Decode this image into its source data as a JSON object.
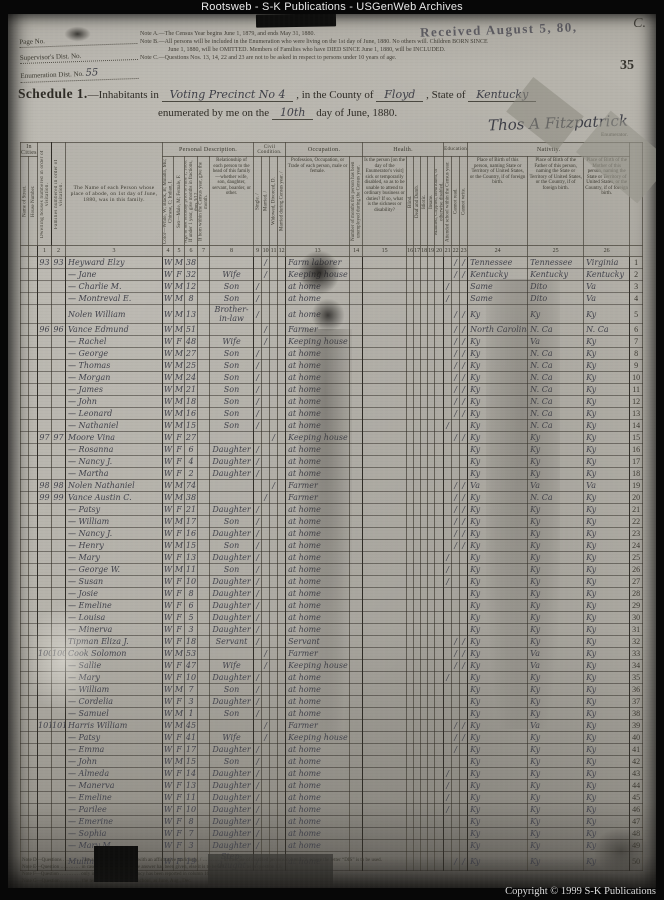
{
  "banner": "Rootsweb - S-K Publications - USGenWeb Archives",
  "copyright": "Copyright © 1999 S-K Publications",
  "page": {
    "received_stamp": "Received August 5, 80,",
    "corner_mark": "C.",
    "sheet_number": "35",
    "ids": {
      "page_no_label": "Page No.",
      "supervisor_label": "Supervisor's Dist. No.",
      "enumeration_label": "Enumeration Dist. No.",
      "enumeration_value": "55"
    },
    "notes": {
      "a": "Note A.—The Census Year begins June 1, 1879, and ends May 31, 1880.",
      "b1": "Note B.—All persons will be included in the Enumeration who were living on the 1st day of June, 1880.  No others will.  Children BORN SINCE",
      "b2": "June 1, 1880, will be OMITTED.  Members of Families who have DIED SINCE June 1, 1880, will be INCLUDED.",
      "c": "Note C.—Questions Nos. 13, 14, 22 and 23 are not to be asked in respect to persons under 10 years of age."
    },
    "schedule": {
      "title": "Schedule 1.",
      "line1_pre": "—Inhabitants in",
      "precinct": "Voting Precinct No 4",
      "county_label": ", in the County of",
      "county": "Floyd",
      "state_label": ", State of",
      "state": "Kentucky",
      "line2_pre": "enumerated by me on the",
      "day": "10th",
      "line2_post": "day of June, 1880.",
      "signature": "Thos A Fitzpatrick",
      "enumerator_label": "Enumerator."
    },
    "footnotes": [
      "Note D—Questions ………… are always to be answered with an affirmative mark only, / ………… in the case of disabled persons column 21, where the letter “DIS” is to be used.",
      "Note E—Question ………… in cases where an affirmative answer has been given, else it is to be left ………… as in question 13.",
      "Note F—Question ………… only in case a yearly occupancy has been reported in column 16.",
      "Note G—Question ………… the term of the year then in school, as June, Aug., Dec."
    ]
  },
  "table": {
    "groups": {
      "in_cities": "In Cities.",
      "personal": "Personal Description.",
      "civil": "Civil Condition.",
      "occupation": "Occupation.",
      "health": "Health.",
      "education": "Education.",
      "nativity": "Nativity."
    },
    "columns": {
      "street": "Name of Street.",
      "house": "House Number.",
      "c1": "Dwelling houses numbered in order of visitation.",
      "c2": "Families numbered in order of visitation.",
      "c3": "The Name of each Person whose place of abode, on 1st day of June, 1880, was in this family.",
      "c4": "Color—White, W; Black, B; Mulatto, Mu; Chinese, C; Indian, I.",
      "c5": "Sex—Male, M; Female, F.",
      "c6": "Age at last birthday prior to June 1, 1880. If under 1 year, give months in fractions, thus 3/12.",
      "c7": "If born within the Census year, give the month.",
      "c8": "Relationship of each person to the head of this family—whether wife, son, daughter, servant, boarder, or other.",
      "c9": "Single. /",
      "c10": "Married. /",
      "c11": "Widowed, Divorced, D.",
      "c12": "Married during Census year. /",
      "c13": "Profession, Occupation, or Trade of each person, male or female.",
      "c14": "Number of months this person has been unemployed during the Census year.",
      "c15": "Is the person [on the day of the Enumerator's visit] sick or temporarily disabled, so as to be unable to attend to ordinary business or duties? If so, what is the sickness or disability?",
      "c16": "Blind.",
      "c17": "Deaf and Dumb.",
      "c18": "Idiotic.",
      "c19": "Insane.",
      "c20": "Maimed, Crippled, Bedridden, or otherwise disabled.",
      "c21": "Attended school within the Census year.",
      "c22": "Cannot read.",
      "c23": "Cannot write.",
      "c24": "Place of Birth of this person, naming State or Territory of United States, or the Country, if of foreign birth.",
      "c25": "Place of Birth of the Father of this person, naming the State or Territory of United States, or the Country, if of foreign birth.",
      "c26": "Place of Birth of the Mother of this person, naming the State or Territory of United States, or the Country, if of foreign birth."
    },
    "numbers": [
      "1",
      "2",
      "3",
      "4",
      "5",
      "6",
      "7",
      "8",
      "9",
      "10",
      "11",
      "12",
      "13",
      "14",
      "15",
      "16",
      "17",
      "18",
      "19",
      "20",
      "21",
      "22",
      "23",
      "24",
      "25",
      "26"
    ],
    "rows": [
      [
        "93",
        "93",
        "Heyward  Elzy",
        "W",
        "M",
        "38",
        "",
        "",
        "/",
        "",
        "Farm laborer",
        "",
        "/",
        "/",
        "Tennessee",
        "Tennessee",
        "Virginia",
        "1"
      ],
      [
        "",
        "",
        "—  Jane",
        "W",
        "F",
        "32",
        "Wife",
        "",
        "/",
        "",
        "Keeping house",
        "",
        "/",
        "/",
        "Kentucky",
        "Kentucky",
        "Kentucky",
        "2"
      ],
      [
        "",
        "",
        "—  Charlie M.",
        "W",
        "M",
        "12",
        "Son",
        "/",
        "",
        "",
        "at home",
        "/",
        "",
        "",
        "Same",
        "Dito",
        "Va",
        "3"
      ],
      [
        "",
        "",
        "—  Montreval E.",
        "W",
        "M",
        "8",
        "Son",
        "/",
        "",
        "",
        "at home",
        "/",
        "",
        "",
        "Same",
        "Dito",
        "Va",
        "4"
      ],
      [
        "",
        "",
        "Nolen  William",
        "W",
        "M",
        "13",
        "Brother-in-law",
        "/",
        "",
        "",
        "at home",
        "",
        "/",
        "/",
        "Ky",
        "Ky",
        "Ky",
        "5"
      ],
      [
        "96",
        "96",
        "Vance  Edmund",
        "W",
        "M",
        "51",
        "",
        "",
        "/",
        "",
        "Farmer",
        "",
        "/",
        "/",
        "North Carolina",
        "N. Ca",
        "N. Ca",
        "6"
      ],
      [
        "",
        "",
        "—  Rachel",
        "W",
        "F",
        "48",
        "Wife",
        "",
        "/",
        "",
        "Keeping house",
        "",
        "/",
        "/",
        "Ky",
        "Va",
        "Ky",
        "7"
      ],
      [
        "",
        "",
        "—  George",
        "W",
        "M",
        "27",
        "Son",
        "/",
        "",
        "",
        "at home",
        "",
        "/",
        "/",
        "Ky",
        "N. Ca",
        "Ky",
        "8"
      ],
      [
        "",
        "",
        "—  Thomas",
        "W",
        "M",
        "25",
        "Son",
        "/",
        "",
        "",
        "at home",
        "",
        "/",
        "/",
        "Ky",
        "N. Ca",
        "Ky",
        "9"
      ],
      [
        "",
        "",
        "—  Morgan",
        "W",
        "M",
        "24",
        "Son",
        "/",
        "",
        "",
        "at home",
        "",
        "/",
        "/",
        "Ky",
        "N. Ca",
        "Ky",
        "10"
      ],
      [
        "",
        "",
        "—  James",
        "W",
        "M",
        "21",
        "Son",
        "/",
        "",
        "",
        "at home",
        "",
        "/",
        "/",
        "Ky",
        "N. Ca",
        "Ky",
        "11"
      ],
      [
        "",
        "",
        "—  John",
        "W",
        "M",
        "18",
        "Son",
        "/",
        "",
        "",
        "at home",
        "",
        "/",
        "/",
        "Ky",
        "N. Ca",
        "Ky",
        "12"
      ],
      [
        "",
        "",
        "—  Leonard",
        "W",
        "M",
        "16",
        "Son",
        "/",
        "",
        "",
        "at home",
        "",
        "/",
        "/",
        "Ky",
        "N. Ca",
        "Ky",
        "13"
      ],
      [
        "",
        "",
        "—  Nathaniel",
        "W",
        "M",
        "15",
        "Son",
        "/",
        "",
        "",
        "at home",
        "/",
        "",
        "",
        "Ky",
        "N. Ca",
        "Ky",
        "14"
      ],
      [
        "97",
        "97",
        "Moore  Vina",
        "W",
        "F",
        "27",
        "",
        "",
        "",
        "/",
        "Keeping house",
        "",
        "/",
        "/",
        "Ky",
        "Ky",
        "Ky",
        "15"
      ],
      [
        "",
        "",
        "—  Rosanna",
        "W",
        "F",
        "6",
        "Daughter",
        "/",
        "",
        "",
        "at home",
        "",
        "",
        "",
        "Ky",
        "Ky",
        "Ky",
        "16"
      ],
      [
        "",
        "",
        "—  Nancy J.",
        "W",
        "F",
        "4",
        "Daughter",
        "/",
        "",
        "",
        "at home",
        "",
        "",
        "",
        "Ky",
        "Ky",
        "Ky",
        "17"
      ],
      [
        "",
        "",
        "—  Martha",
        "W",
        "F",
        "2",
        "Daughter",
        "/",
        "",
        "",
        "at home",
        "",
        "",
        "",
        "Ky",
        "Ky",
        "Ky",
        "18"
      ],
      [
        "98",
        "98",
        "Nolen  Nathaniel",
        "W",
        "M",
        "74",
        "",
        "",
        "",
        "/",
        "Farmer",
        "",
        "/",
        "/",
        "Va",
        "Va",
        "Va",
        "19"
      ],
      [
        "99",
        "99",
        "Vance  Austin C.",
        "W",
        "M",
        "38",
        "",
        "",
        "/",
        "",
        "Farmer",
        "",
        "/",
        "/",
        "Ky",
        "N. Ca",
        "Ky",
        "20"
      ],
      [
        "",
        "",
        "—  Patsy",
        "W",
        "F",
        "21",
        "Daughter",
        "/",
        "",
        "",
        "at home",
        "",
        "/",
        "/",
        "Ky",
        "Ky",
        "Ky",
        "21"
      ],
      [
        "",
        "",
        "—  William",
        "W",
        "M",
        "17",
        "Son",
        "/",
        "",
        "",
        "at home",
        "",
        "/",
        "/",
        "Ky",
        "Ky",
        "Ky",
        "22"
      ],
      [
        "",
        "",
        "—  Nancy J.",
        "W",
        "F",
        "16",
        "Daughter",
        "/",
        "",
        "",
        "at home",
        "",
        "/",
        "/",
        "Ky",
        "Ky",
        "Ky",
        "23"
      ],
      [
        "",
        "",
        "—  Henry",
        "W",
        "M",
        "15",
        "Son",
        "/",
        "",
        "",
        "at home",
        "",
        "/",
        "/",
        "Ky",
        "Ky",
        "Ky",
        "24"
      ],
      [
        "",
        "",
        "—  Mary",
        "W",
        "F",
        "13",
        "Daughter",
        "/",
        "",
        "",
        "at home",
        "/",
        "",
        "",
        "Ky",
        "Ky",
        "Ky",
        "25"
      ],
      [
        "",
        "",
        "—  George W.",
        "W",
        "M",
        "11",
        "Son",
        "/",
        "",
        "",
        "at home",
        "/",
        "",
        "",
        "Ky",
        "Ky",
        "Ky",
        "26"
      ],
      [
        "",
        "",
        "—  Susan",
        "W",
        "F",
        "10",
        "Daughter",
        "/",
        "",
        "",
        "at home",
        "/",
        "",
        "",
        "Ky",
        "Ky",
        "Ky",
        "27"
      ],
      [
        "",
        "",
        "—  Josie",
        "W",
        "F",
        "8",
        "Daughter",
        "/",
        "",
        "",
        "at home",
        "",
        "",
        "",
        "Ky",
        "Ky",
        "Ky",
        "28"
      ],
      [
        "",
        "",
        "—  Emeline",
        "W",
        "F",
        "6",
        "Daughter",
        "/",
        "",
        "",
        "at home",
        "",
        "",
        "",
        "Ky",
        "Ky",
        "Ky",
        "29"
      ],
      [
        "",
        "",
        "—  Louisa",
        "W",
        "F",
        "5",
        "Daughter",
        "/",
        "",
        "",
        "at home",
        "",
        "",
        "",
        "Ky",
        "Ky",
        "Ky",
        "30"
      ],
      [
        "",
        "",
        "—  Minerva",
        "W",
        "F",
        "3",
        "Daughter",
        "/",
        "",
        "",
        "at home",
        "",
        "",
        "",
        "Ky",
        "Ky",
        "Ky",
        "31"
      ],
      [
        "",
        "",
        "Tipman  Eliza J.",
        "W",
        "F",
        "18",
        "Servant",
        "/",
        "",
        "",
        "Servant",
        "",
        "/",
        "/",
        "Ky",
        "Ky",
        "Ky",
        "32"
      ],
      [
        "100",
        "100",
        "Cook  Solomon",
        "W",
        "M",
        "53",
        "",
        "",
        "/",
        "",
        "Farmer",
        "",
        "/",
        "/",
        "Ky",
        "Va",
        "Ky",
        "33"
      ],
      [
        "",
        "",
        "—  Sallie",
        "W",
        "F",
        "47",
        "Wife",
        "",
        "/",
        "",
        "Keeping house",
        "",
        "/",
        "/",
        "Ky",
        "Va",
        "Ky",
        "34"
      ],
      [
        "",
        "",
        "—  Mary",
        "W",
        "F",
        "10",
        "Daughter",
        "/",
        "",
        "",
        "at home",
        "/",
        "",
        "",
        "Ky",
        "Ky",
        "Ky",
        "35"
      ],
      [
        "",
        "",
        "—  William",
        "W",
        "M",
        "7",
        "Son",
        "/",
        "",
        "",
        "at home",
        "",
        "",
        "",
        "Ky",
        "Ky",
        "Ky",
        "36"
      ],
      [
        "",
        "",
        "—  Cordelia",
        "W",
        "F",
        "3",
        "Daughter",
        "/",
        "",
        "",
        "at home",
        "",
        "",
        "",
        "Ky",
        "Ky",
        "Ky",
        "37"
      ],
      [
        "",
        "",
        "—  Samuel",
        "W",
        "M",
        "1",
        "Son",
        "/",
        "",
        "",
        "at home",
        "",
        "",
        "",
        "Ky",
        "Ky",
        "Ky",
        "38"
      ],
      [
        "101",
        "101",
        "Harris  William",
        "W",
        "M",
        "45",
        "",
        "",
        "/",
        "",
        "Farmer",
        "",
        "/",
        "/",
        "Ky",
        "Va",
        "Ky",
        "39"
      ],
      [
        "",
        "",
        "—  Patsy",
        "W",
        "F",
        "41",
        "Wife",
        "",
        "/",
        "",
        "Keeping house",
        "",
        "/",
        "/",
        "Ky",
        "Ky",
        "Ky",
        "40"
      ],
      [
        "",
        "",
        "—  Emma",
        "W",
        "F",
        "17",
        "Daughter",
        "/",
        "",
        "",
        "at home",
        "",
        "/",
        "",
        "Ky",
        "Ky",
        "Ky",
        "41"
      ],
      [
        "",
        "",
        "—  John",
        "W",
        "M",
        "15",
        "Son",
        "/",
        "",
        "",
        "at home",
        "",
        "",
        "",
        "Ky",
        "Ky",
        "Ky",
        "42"
      ],
      [
        "",
        "",
        "—  Almeda",
        "W",
        "F",
        "14",
        "Daughter",
        "/",
        "",
        "",
        "at home",
        "/",
        "",
        "",
        "Ky",
        "Ky",
        "Ky",
        "43"
      ],
      [
        "",
        "",
        "—  Manerva",
        "W",
        "F",
        "13",
        "Daughter",
        "/",
        "",
        "",
        "at home",
        "/",
        "",
        "",
        "Ky",
        "Ky",
        "Ky",
        "44"
      ],
      [
        "",
        "",
        "—  Emeline",
        "W",
        "F",
        "11",
        "Daughter",
        "/",
        "",
        "",
        "at home",
        "/",
        "",
        "",
        "Ky",
        "Ky",
        "Ky",
        "45"
      ],
      [
        "",
        "",
        "—  Parilee",
        "W",
        "F",
        "10",
        "Daughter",
        "/",
        "",
        "",
        "at home",
        "/",
        "",
        "",
        "Ky",
        "Ky",
        "Ky",
        "46"
      ],
      [
        "",
        "",
        "—  Emerine",
        "W",
        "F",
        "8",
        "Daughter",
        "/",
        "",
        "",
        "at home",
        "",
        "",
        "",
        "Ky",
        "Ky",
        "Ky",
        "47"
      ],
      [
        "",
        "",
        "—  Sophia",
        "W",
        "F",
        "7",
        "Daughter",
        "/",
        "",
        "",
        "at home",
        "",
        "",
        "",
        "Ky",
        "Ky",
        "Ky",
        "48"
      ],
      [
        "",
        "",
        "—  Mary M.",
        "W",
        "F",
        "3",
        "Daughter",
        "/",
        "",
        "",
        "at home",
        "",
        "",
        "",
        "Ky",
        "Ky",
        "Ky",
        "49"
      ],
      [
        "",
        "",
        "Mullins  Sarah",
        "W",
        "F",
        "19",
        "Step-daught",
        "/",
        "",
        "",
        "at home",
        "",
        "/",
        "/",
        "Ky",
        "Ky",
        "Ky",
        "50"
      ]
    ]
  }
}
